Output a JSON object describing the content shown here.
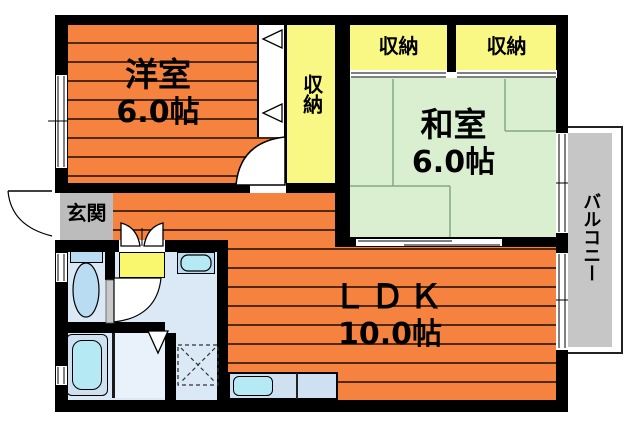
{
  "rooms": {
    "western": {
      "name": "洋室",
      "size": "6.0帖"
    },
    "japanese": {
      "name": "和室",
      "size": "6.0帖"
    },
    "ldk": {
      "name": "ＬＤＫ",
      "size": "10.0帖"
    },
    "entrance": {
      "label": "玄関"
    },
    "closet_middle": {
      "label": "収納"
    },
    "closet_left": {
      "label": "収納"
    },
    "closet_right": {
      "label": "収納"
    },
    "balcony": {
      "label": "バルコニー"
    }
  },
  "colors": {
    "wall": "#000000",
    "floor-orange": "#f5823e",
    "stripe": "#54280a",
    "tatami-green": "#d9efcf",
    "tatami-line": "#85a785",
    "closet-yellow": "#f9f884",
    "door-yellow": "#f8f76d",
    "gray": "#bcbcbc",
    "balcony-gray": "#c6c6c6",
    "wet-blue": "#dbe9f6",
    "shower-blue": "#e9f1fa",
    "fixture-blue": "#badcf2",
    "water-cyan": "#b5e9f3",
    "counter-blue": "#cfe0f1"
  }
}
